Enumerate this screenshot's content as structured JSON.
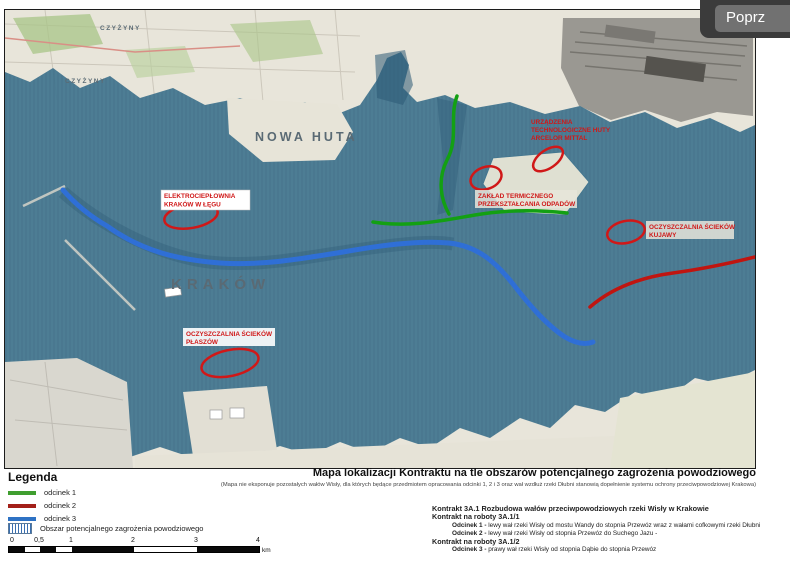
{
  "overlay": {
    "prev_button_label": "Poprz"
  },
  "map": {
    "city_labels": [
      {
        "text": "CZYŻYNY"
      },
      {
        "text": "CZYŻYNY"
      },
      {
        "text": "NOWA HUTA"
      },
      {
        "text": "KRAKÓW"
      }
    ],
    "annotations": [
      {
        "lines": [
          "ELEKTROCIEPŁOWNIA",
          "KRAKÓW W ŁĘGU"
        ]
      },
      {
        "lines": [
          "URZĄDZENIA",
          "TECHNOLOGICZNE HUTY",
          "ARCELOR MITTAL"
        ]
      },
      {
        "lines": [
          "ZAKŁAD TERMICZNEGO",
          "PRZEKSZTAŁCANIA ODPADÓW"
        ]
      },
      {
        "lines": [
          "OCZYSZCZALNIA ŚCIEKÓW",
          "KUJAWY"
        ]
      },
      {
        "lines": [
          "OCZYSZCZALNIA ŚCIEKÓW",
          "PŁASZÓW"
        ]
      }
    ]
  },
  "legend": {
    "title": "Legenda",
    "items": [
      {
        "label": "odcinek 1",
        "color": "#3f9e2f"
      },
      {
        "label": "odcinek 2",
        "color": "#a32019"
      },
      {
        "label": "odcinek 3",
        "color": "#2e72c4"
      }
    ],
    "area_item": {
      "label": "Obszar potencjalnego zagrożenia powodziowego",
      "color": "#3a6fb0"
    },
    "scale": {
      "ticks": [
        "0",
        "0,5",
        "1",
        "2",
        "3",
        "4"
      ],
      "unit": "km"
    }
  },
  "title_block": {
    "title": "Mapa lokalizacji Kontraktu na tle obszarów potencjalnego zagrożenia powodziowego",
    "subtitle": "(Mapa nie eksponuje pozostałych wałów Wisły, dla których będące przedmiotem opracowania odcinki 1, 2 i 3 oraz wał wzdłuż rzeki Dłubni stanowią dopełnienie systemu ochrony przeciwpowodziowej Krakowa)",
    "contract_heading": "Kontrakt 3A.1 Rozbudowa wałów przeciwpowodziowych rzeki Wisły w Krakowie",
    "works1_heading": "Kontrakt na roboty 3A.1/1",
    "odcinek1_label": "Odcinek 1 -",
    "odcinek1_text": "lewy wał rzeki Wisły od mostu Wandy do stopnia Przewóz wraz z wałami cofkowymi rzeki Dłubni",
    "odcinek2_label": "Odcinek 2 -",
    "odcinek2_text": "lewy wał rzeki Wisły od stopnia Przewóz do Suchego Jazu -",
    "works2_heading": "Kontrakt na roboty 3A.1/2",
    "odcinek3_label": "Odcinek 3 -",
    "odcinek3_text": "prawy wał rzeki Wisły od stopnia Dąbie do stopnia Przewóz"
  },
  "colors": {
    "flood_area": "#41758f",
    "annotation_red": "#d01818",
    "route_green": "#13a013",
    "route_red": "#c01510",
    "route_blue": "#2f6fd6"
  }
}
